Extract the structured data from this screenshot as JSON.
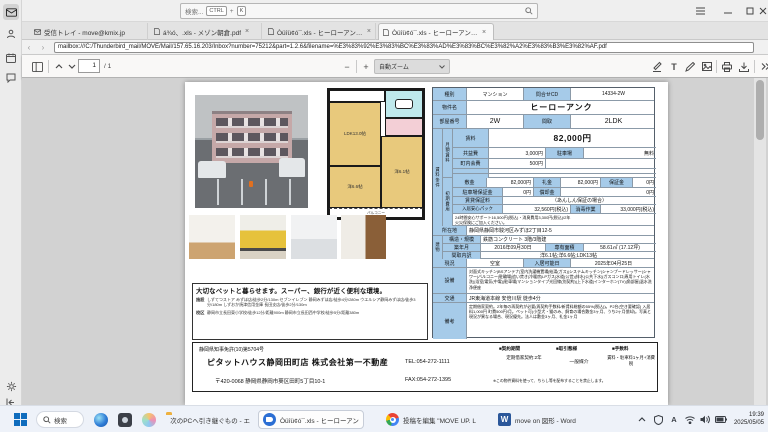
{
  "colors": {
    "cell_blue": "#a6cbe9",
    "taskbar_bg": "#eef2f9",
    "accent_blue": "#0f6cbd"
  },
  "titlebar": {
    "search_text": "検索...",
    "key_ctrl": "CTRL",
    "key_plus": "+",
    "key_k": "K"
  },
  "tabs": [
    {
      "label": "受信トレイ - move@kmix.jp",
      "close": ""
    },
    {
      "label": "á¾ó、.xls - メゾン朝倉.pdf",
      "close": "×"
    },
    {
      "label": "Òüîü¢ó¯.xls - ヒーローアンク.p",
      "close": "×"
    },
    {
      "label": "Òüîü¢ó¯.xls - ヒーローアンク.p",
      "close": "×"
    }
  ],
  "urlbar": {
    "value": "mailbox:///C:/Thunderbird_mail/MOVE/Mail/157.65.16.203/Inbox?number=75212&part=1.2.6&filename=%E3%83%92%E3%83%BC%E3%83%AD%E3%83%BC%E3%82%A2%E3%83%B3%E3%82%AF.pdf"
  },
  "pdfbar": {
    "page": "1",
    "page_total": "/ 1",
    "zoom": "自動ズーム",
    "minus": "−",
    "plus": "+"
  },
  "sheet": {
    "r1": {
      "a": "種別",
      "b": "マンション",
      "c": "問合せCD",
      "d": "14334-2W"
    },
    "r2": {
      "a": "物件名",
      "b": "ヒーローアンク"
    },
    "r3": {
      "a": "部屋番号",
      "b": "2W",
      "c": "間取",
      "d": "2LDK"
    },
    "g1": "賃料条件",
    "g2": "月額賃料",
    "g3": "初期費用",
    "g4": "建物",
    "m1": {
      "a": "賃料",
      "b": "82,000円"
    },
    "m2": {
      "a": "共益費",
      "b": "3,000円",
      "c": "駐車場",
      "d": "無料"
    },
    "m3": {
      "a": "町内会費",
      "b": "500円"
    },
    "i1": {
      "a": "敷金",
      "b": "82,000円",
      "c": "礼金",
      "d": "82,000円",
      "e": "保証金",
      "f": "0円"
    },
    "i2": {
      "a": "駐車場保証金",
      "b": "0円",
      "c": "償却金",
      "d": "0円"
    },
    "i3": {
      "a": "賃貸保証料",
      "b": "（あんしん保証の場合）"
    },
    "i4": {
      "a": "入居安心パック",
      "b": "32,560円(税込)",
      "c": "消毒作業",
      "d": "33,000円(税込)"
    },
    "i5": "24時間安心サポート16,500円(税込)・消臭費用3,300円(税込)/2年",
    "i6": "火災保険にご加入ください。",
    "loc": {
      "a": "所在地",
      "b": "静岡県静岡市駿河区みずほ2丁目12-5"
    },
    "b1": {
      "a": "構造・規模",
      "b": "鉄筋コンクリート 3階/3階建"
    },
    "b2": {
      "a": "築年月",
      "b": "2016年09月30日",
      "c": "専有面積",
      "d": "58.61㎡ (17.12坪)"
    },
    "b3": {
      "a": "間取内訳",
      "b": "洋6.1帖;洋6.6帖;LDK13帖"
    },
    "st": {
      "a": "現況",
      "b": "空室",
      "c": "入居可能日",
      "d": "2025年04月25日"
    },
    "eq": {
      "a": "設備",
      "b": "対面式キッチン|BSアンテナ|室内洗濯機置場|給湯(ガス)|システムキッチン|シャンプードレッサー|シャワー|バルコニー|駐輪場|追い焚き|冷暖房|LPガス|水道(公営)|排水(公共下水)|ガスコンロ|専用トイレ(水洗)|浴室|電気(中電)|駐車場|マンションタイプ光回線(別契約)|上下水道|インターホン(TV)|角部屋|温水洗浄便座"
    },
    "ac": {
      "a": "交通",
      "b": "JR東海道本線 安倍川駅 徒歩4分"
    },
    "bk": {
      "a": "備考",
      "b": "定期借家契約。2年毎の再契約が必要(再契約手数料/新賃料総額の55%(税込))。P2台(空き要確認) 入居料1,000円 町費500円/月。ペット可(小型犬・猫のみ、飼育の場合敷金3ヶ月、うち2ヶ月償却)。写真と現況が異なる場合、現況優先。法人は敷金3ヶ月、礼金1ヶ月"
    }
  },
  "plan": {
    "ldk": "LDK13.0帖",
    "w66": "洋6.6帖",
    "w61": "洋6.1帖",
    "bal": "バルコニー"
  },
  "petbox": {
    "headline": "大切なペットと暮らせます。スーパー、銀行が近く便利な環境。",
    "f_label": "施設",
    "f_text": "しずてつストア みずほ店/徒歩2分/130m セブンイレブン 静岡みずほ店/徒歩4分/280m ウエルシア静岡みずほ店/徒歩3分/180m しずおか焼津信用金庫 長田支店/徒歩2分/130m",
    "s_label": "校区",
    "s_text": "静岡市立長田東小学校/徒歩12分/距離900m 静岡市立長田西中学校/徒歩5分/距離380m"
  },
  "footer": {
    "license": "静岡県知事免許(10)第5704号",
    "company": "ピタットハウス静岡田町店 株式会社第一不動産",
    "address": "〒420-0068 静岡県静岡市葵区田町5丁目10-1",
    "tel": "TEL:054-272-1111",
    "fax": "FAX:054-272-1395",
    "h_contract": "■契約期間",
    "v_contract": "定期借家契約:2年",
    "h_deal": "■取引態様",
    "v_deal": "一般媒介",
    "h_fee": "■手数料",
    "v_fee": "賃料・駐車料1ヶ月+消費税",
    "notice": "※この物件資料を使って、ちらし等を配布することを禁止します。"
  },
  "taskbar": {
    "search": "検索",
    "explorer": "次のPCへ引き継ぐもの - エ",
    "thunderbird": "Òüîü¢ó¯.xls - ヒーローアン",
    "chrome": "投稿を編集 \"MOVE UP. L",
    "word": "move on 図形 - Word",
    "ime": "A",
    "time": "19:39",
    "date": "2025/05/05"
  }
}
